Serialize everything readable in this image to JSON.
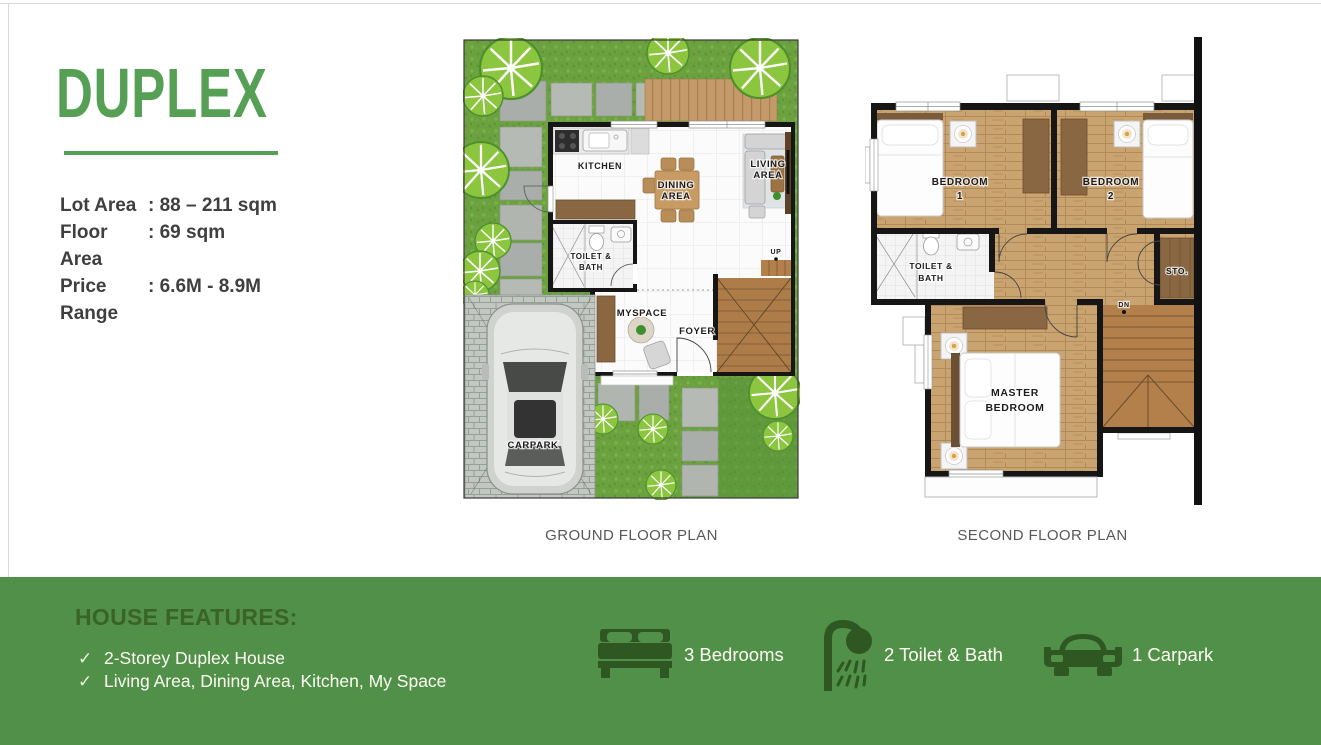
{
  "panel": {
    "title": "DUPLEX",
    "specs": [
      {
        "label": "Lot Area",
        "value": ": 88 – 211 sqm"
      },
      {
        "label": "Floor Area",
        "value": ": 69 sqm"
      },
      {
        "label": "Price Range",
        "value": ": 6.6M - 8.9M"
      }
    ]
  },
  "ground_floor": {
    "caption": "GROUND FLOOR PLAN",
    "labels": {
      "kitchen": "KITCHEN",
      "dining1": "DINING",
      "dining2": "AREA",
      "living1": "LIVING",
      "living2": "AREA",
      "toilet1": "TOILET &",
      "toilet2": "BATH",
      "myspace": "MYSPACE",
      "foyer": "FOYER",
      "carpark": "CARPARK",
      "up": "UP"
    }
  },
  "second_floor": {
    "caption": "SECOND FLOOR PLAN",
    "labels": {
      "bedroom1a": "BEDROOM",
      "bedroom1b": "1",
      "bedroom2a": "BEDROOM",
      "bedroom2b": "2",
      "toilet1": "TOILET &",
      "toilet2": "BATH",
      "sto": "STO.",
      "master1": "MASTER",
      "master2": "BEDROOM",
      "dn": "DN"
    }
  },
  "features": {
    "heading": "HOUSE FEATURES:",
    "check": "✓",
    "items": [
      "2-Storey Duplex House",
      "Living Area, Dining Area, Kitchen, My Space"
    ],
    "stats": [
      {
        "icon": "bed-icon",
        "label": "3 Bedrooms"
      },
      {
        "icon": "shower-icon",
        "label": "2 Toilet & Bath"
      },
      {
        "icon": "car-icon",
        "label": "1 Carpark"
      }
    ]
  },
  "colors": {
    "title_green": "#55a055",
    "bar_green": "#519049",
    "feature_heading_green": "#3a6326",
    "icon_green": "#2e5722"
  }
}
